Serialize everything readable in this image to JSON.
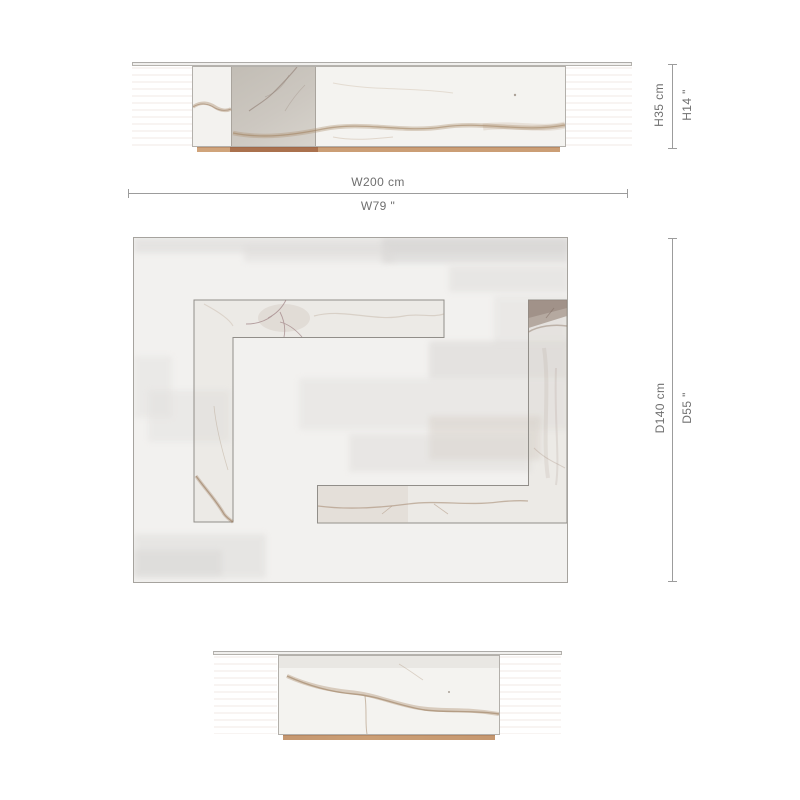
{
  "page": {
    "type": "furniture dimension drawing",
    "background": "#ffffff"
  },
  "views": {
    "front": {
      "name": "front elevation"
    },
    "plan": {
      "name": "top plan view"
    },
    "side": {
      "name": "side elevation"
    }
  },
  "dimensions": {
    "height": {
      "metric": "H35 cm",
      "imperial": "H14 \""
    },
    "width": {
      "metric": "W200 cm",
      "imperial": "W79 \""
    },
    "depth": {
      "metric": "D140 cm",
      "imperial": "D55 \""
    }
  },
  "colors": {
    "dimension_text": "#6f6f6f",
    "dimension_line": "#9c9c9c",
    "drawing_outline": "#a6a39e",
    "marble_light": "#f4f3f0",
    "marble_gray_panel": "#c9c4bc",
    "marble_vein": "#b09478",
    "plinth_wood": "#cb9e75",
    "plinth_wood_dark": "#aa714e"
  }
}
